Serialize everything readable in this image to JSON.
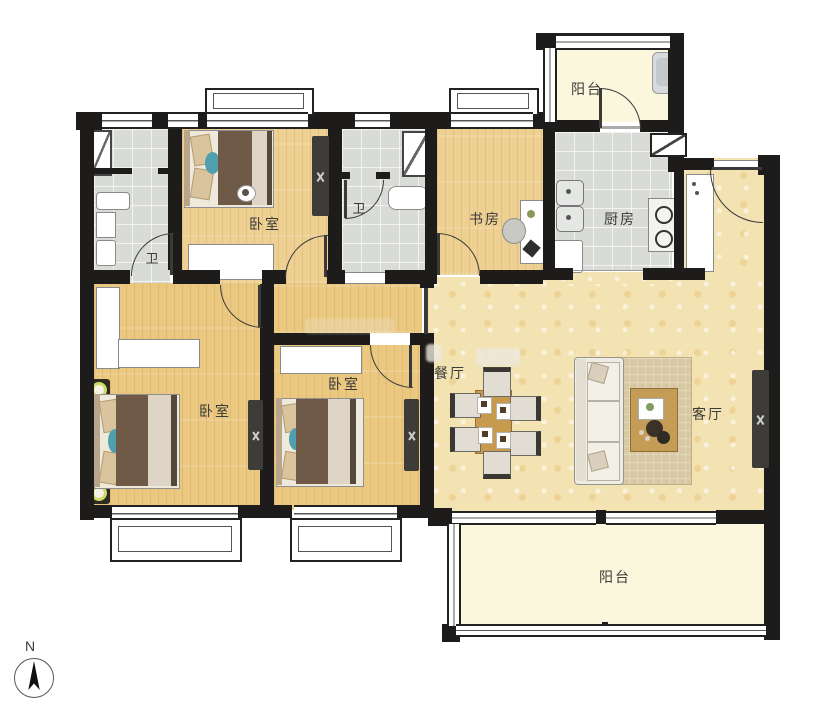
{
  "title": "residential-floor-plan",
  "palette": {
    "wall": "#1d1c1a",
    "wood": "#eac87f",
    "wood2": "#edd092",
    "tile": "#d9dbd6",
    "hall": "#f3e3b2",
    "balcony": "#faf7dc",
    "accent_bed_blanket": "#6e5a47",
    "accent_table_wood": "#c89a4e",
    "accent_ring": "#ccdb66"
  },
  "rooms": {
    "balcony_top": {
      "label": "阳台"
    },
    "kitchen": {
      "label": "厨房"
    },
    "study": {
      "label": "书房"
    },
    "bath_main": {
      "label": "卫"
    },
    "bath_second": {
      "label": "卫"
    },
    "bedroom_top": {
      "label": "卧室"
    },
    "bedroom_master": {
      "label": "卧室"
    },
    "bedroom_middle": {
      "label": "卧室"
    },
    "dining": {
      "label": "餐厅"
    },
    "living": {
      "label": "客厅"
    },
    "balcony_bottom": {
      "label": "阳台"
    }
  },
  "compass": {
    "north_label": "N"
  }
}
